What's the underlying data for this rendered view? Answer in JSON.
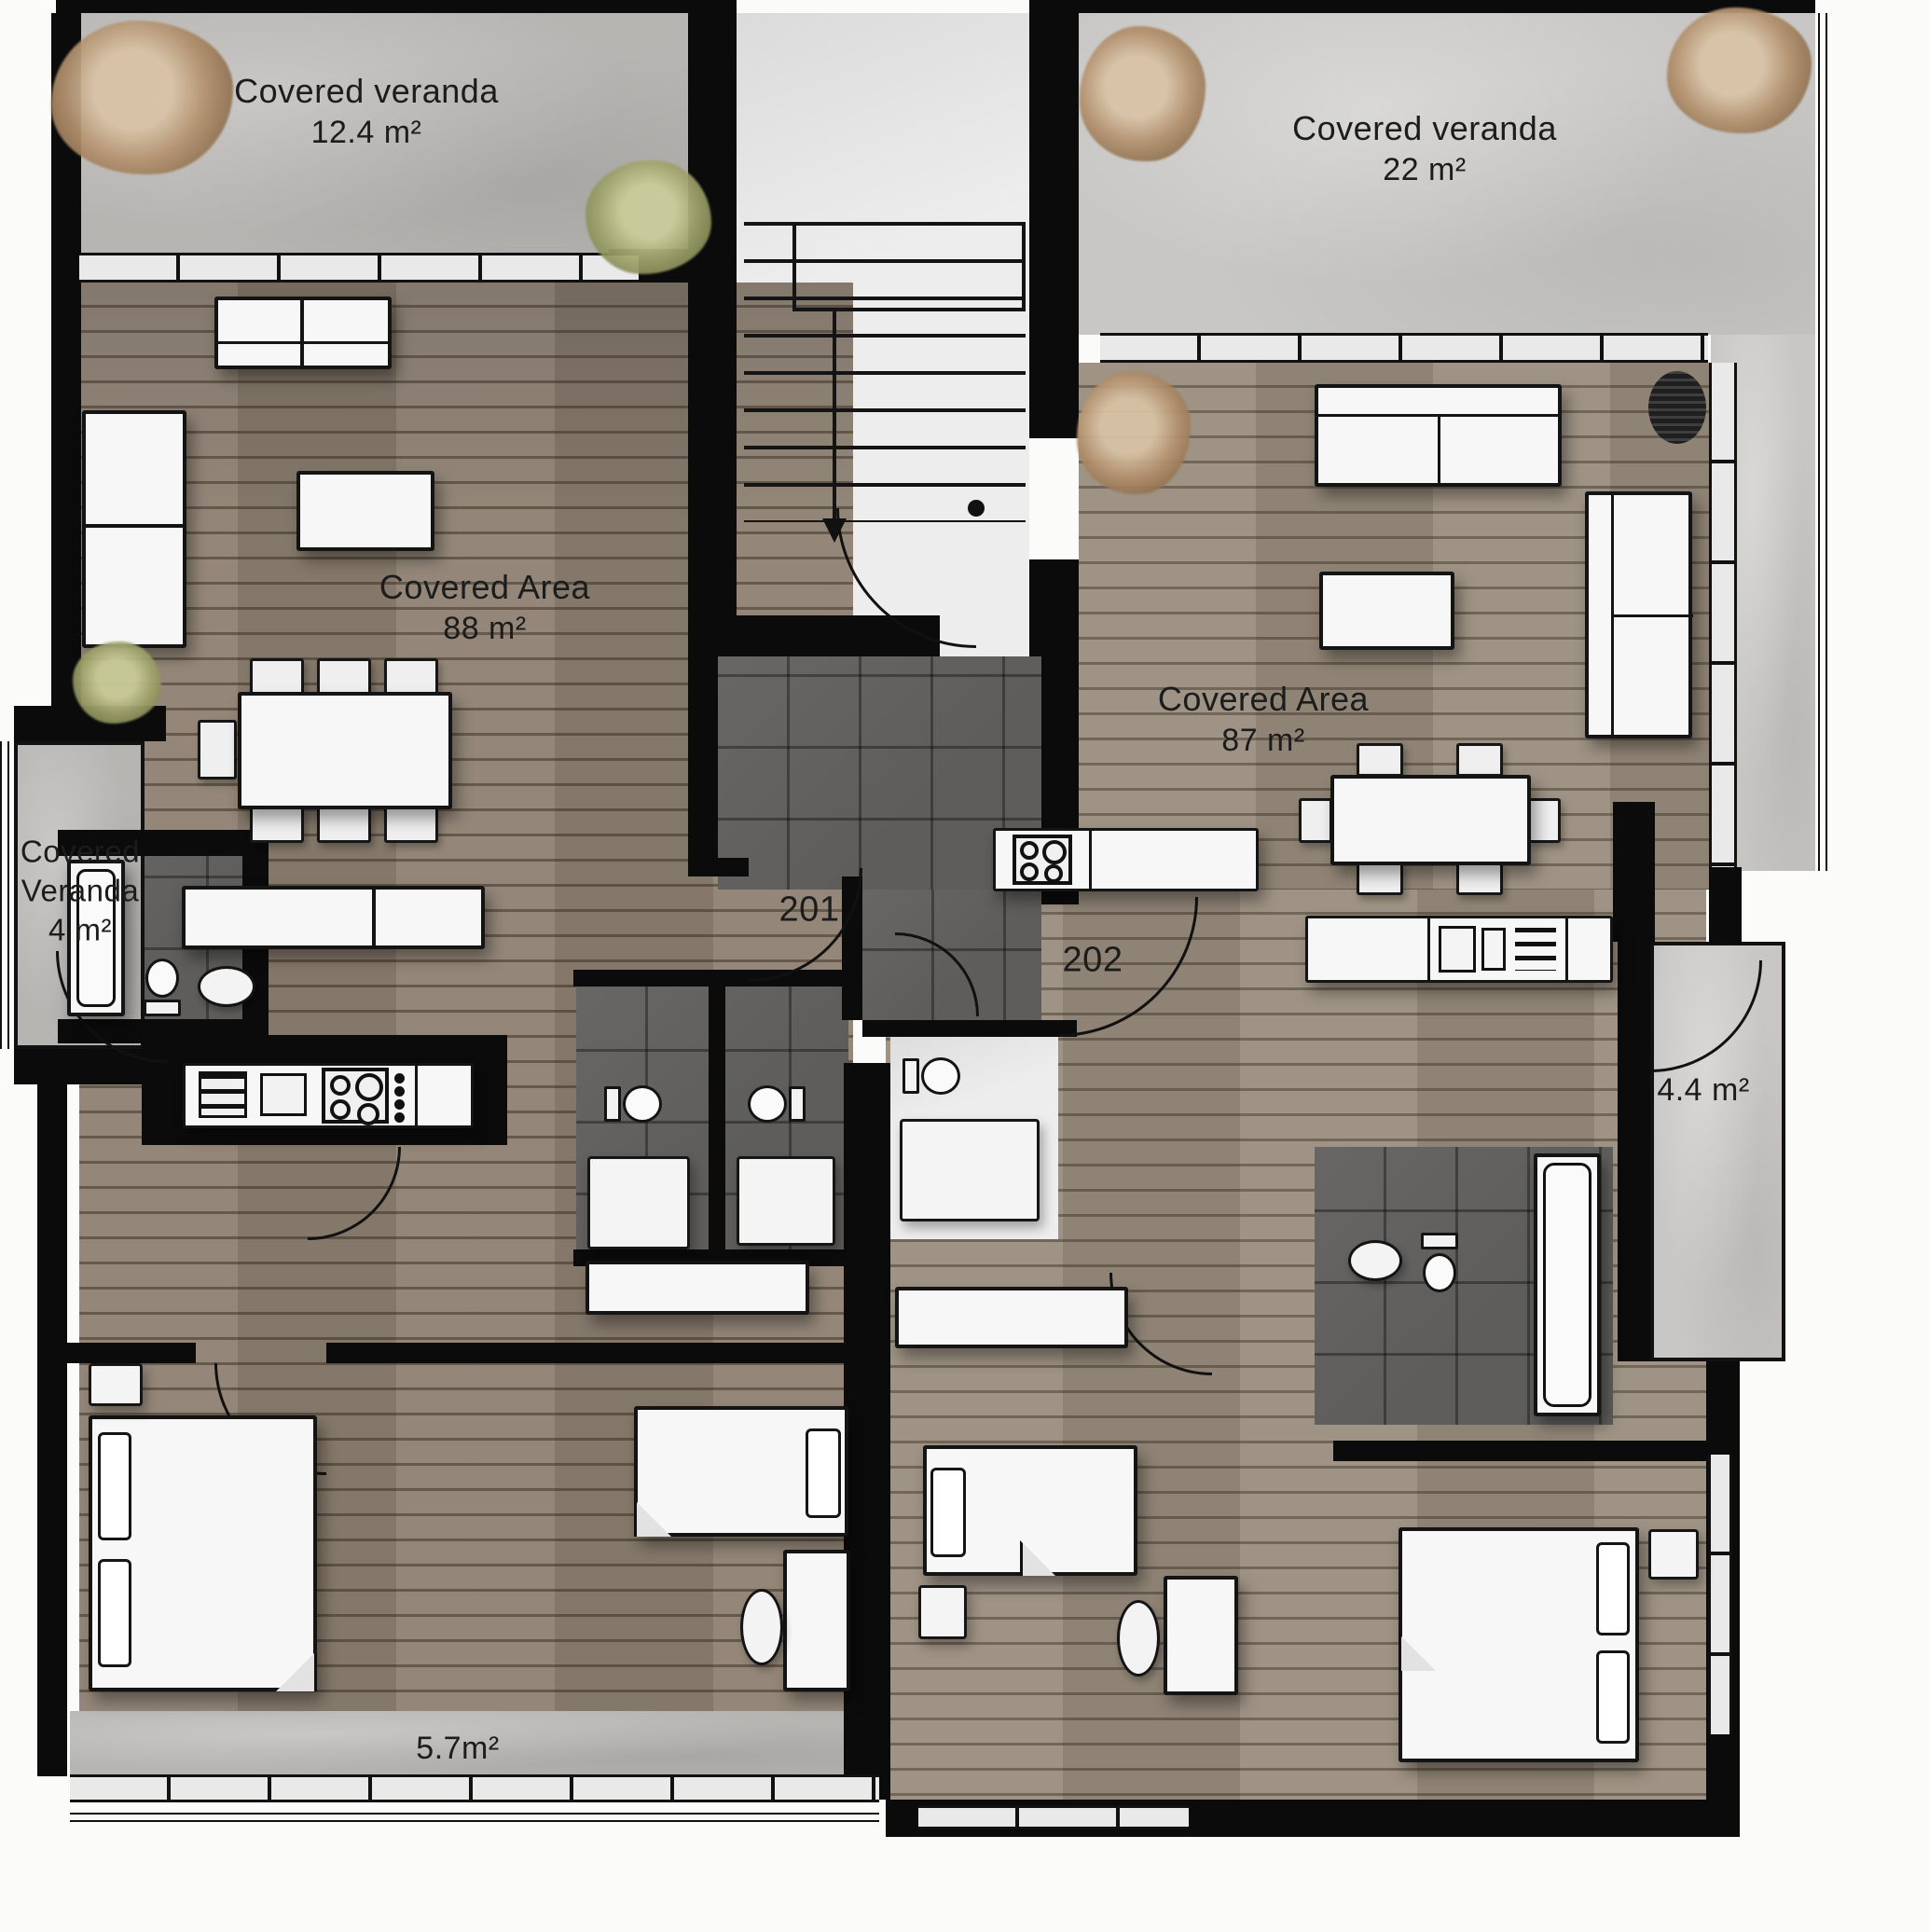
{
  "plan": {
    "labels": {
      "veranda_top_left": {
        "line1": "Covered veranda",
        "line2": "12.4 m²"
      },
      "veranda_top_right": {
        "line1": "Covered veranda",
        "line2": "22 m²"
      },
      "covered_area_left": {
        "line1": "Covered Area",
        "line2": "88 m²"
      },
      "covered_area_right": {
        "line1": "Covered Area",
        "line2": "87 m²"
      },
      "veranda_left_small": {
        "line1": "Covered",
        "line2": "Veranda",
        "line3": "4 m²"
      },
      "unit_left_number": "201",
      "unit_right_number": "202",
      "veranda_right_small": "4.4 m²",
      "veranda_bottom": "5.7m²"
    },
    "colors": {
      "wall": "#0b0b0b",
      "wood_floor": "#8e8172",
      "concrete_floor": "#b7b5b2",
      "dark_tile_floor": "#5e5d5b",
      "furniture_fill": "#f7f7f7",
      "plant_green": "#a3a66e",
      "plant_brown": "#b2906c"
    }
  }
}
